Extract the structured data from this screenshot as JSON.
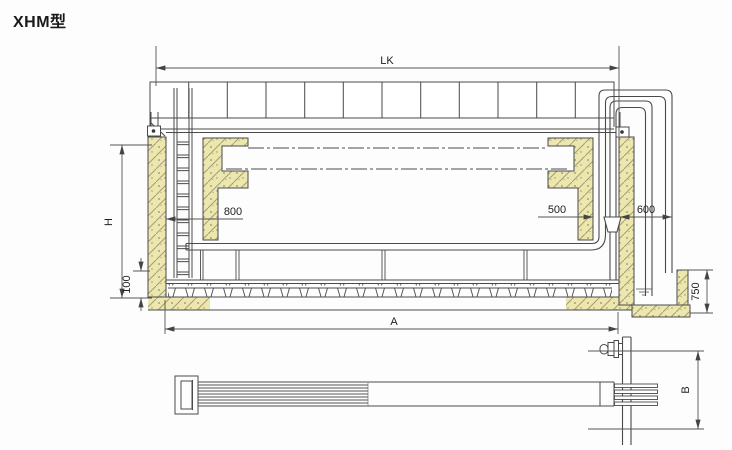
{
  "title": "XHM型",
  "colors": {
    "line": "#4a4a4a",
    "dim_line": "#555555",
    "hatch_fill": "#ece7ac",
    "hatch_stroke": "#a39d7e",
    "background": "#fdfdfd",
    "text": "#222222"
  },
  "section_view": {
    "dims": {
      "lk": "LK",
      "h": "H",
      "d100": "100",
      "d800": "800",
      "d500": "500",
      "d600": "600",
      "d750": "750",
      "a": "A"
    }
  },
  "detail_view": {
    "dims": {
      "b": "B"
    }
  }
}
